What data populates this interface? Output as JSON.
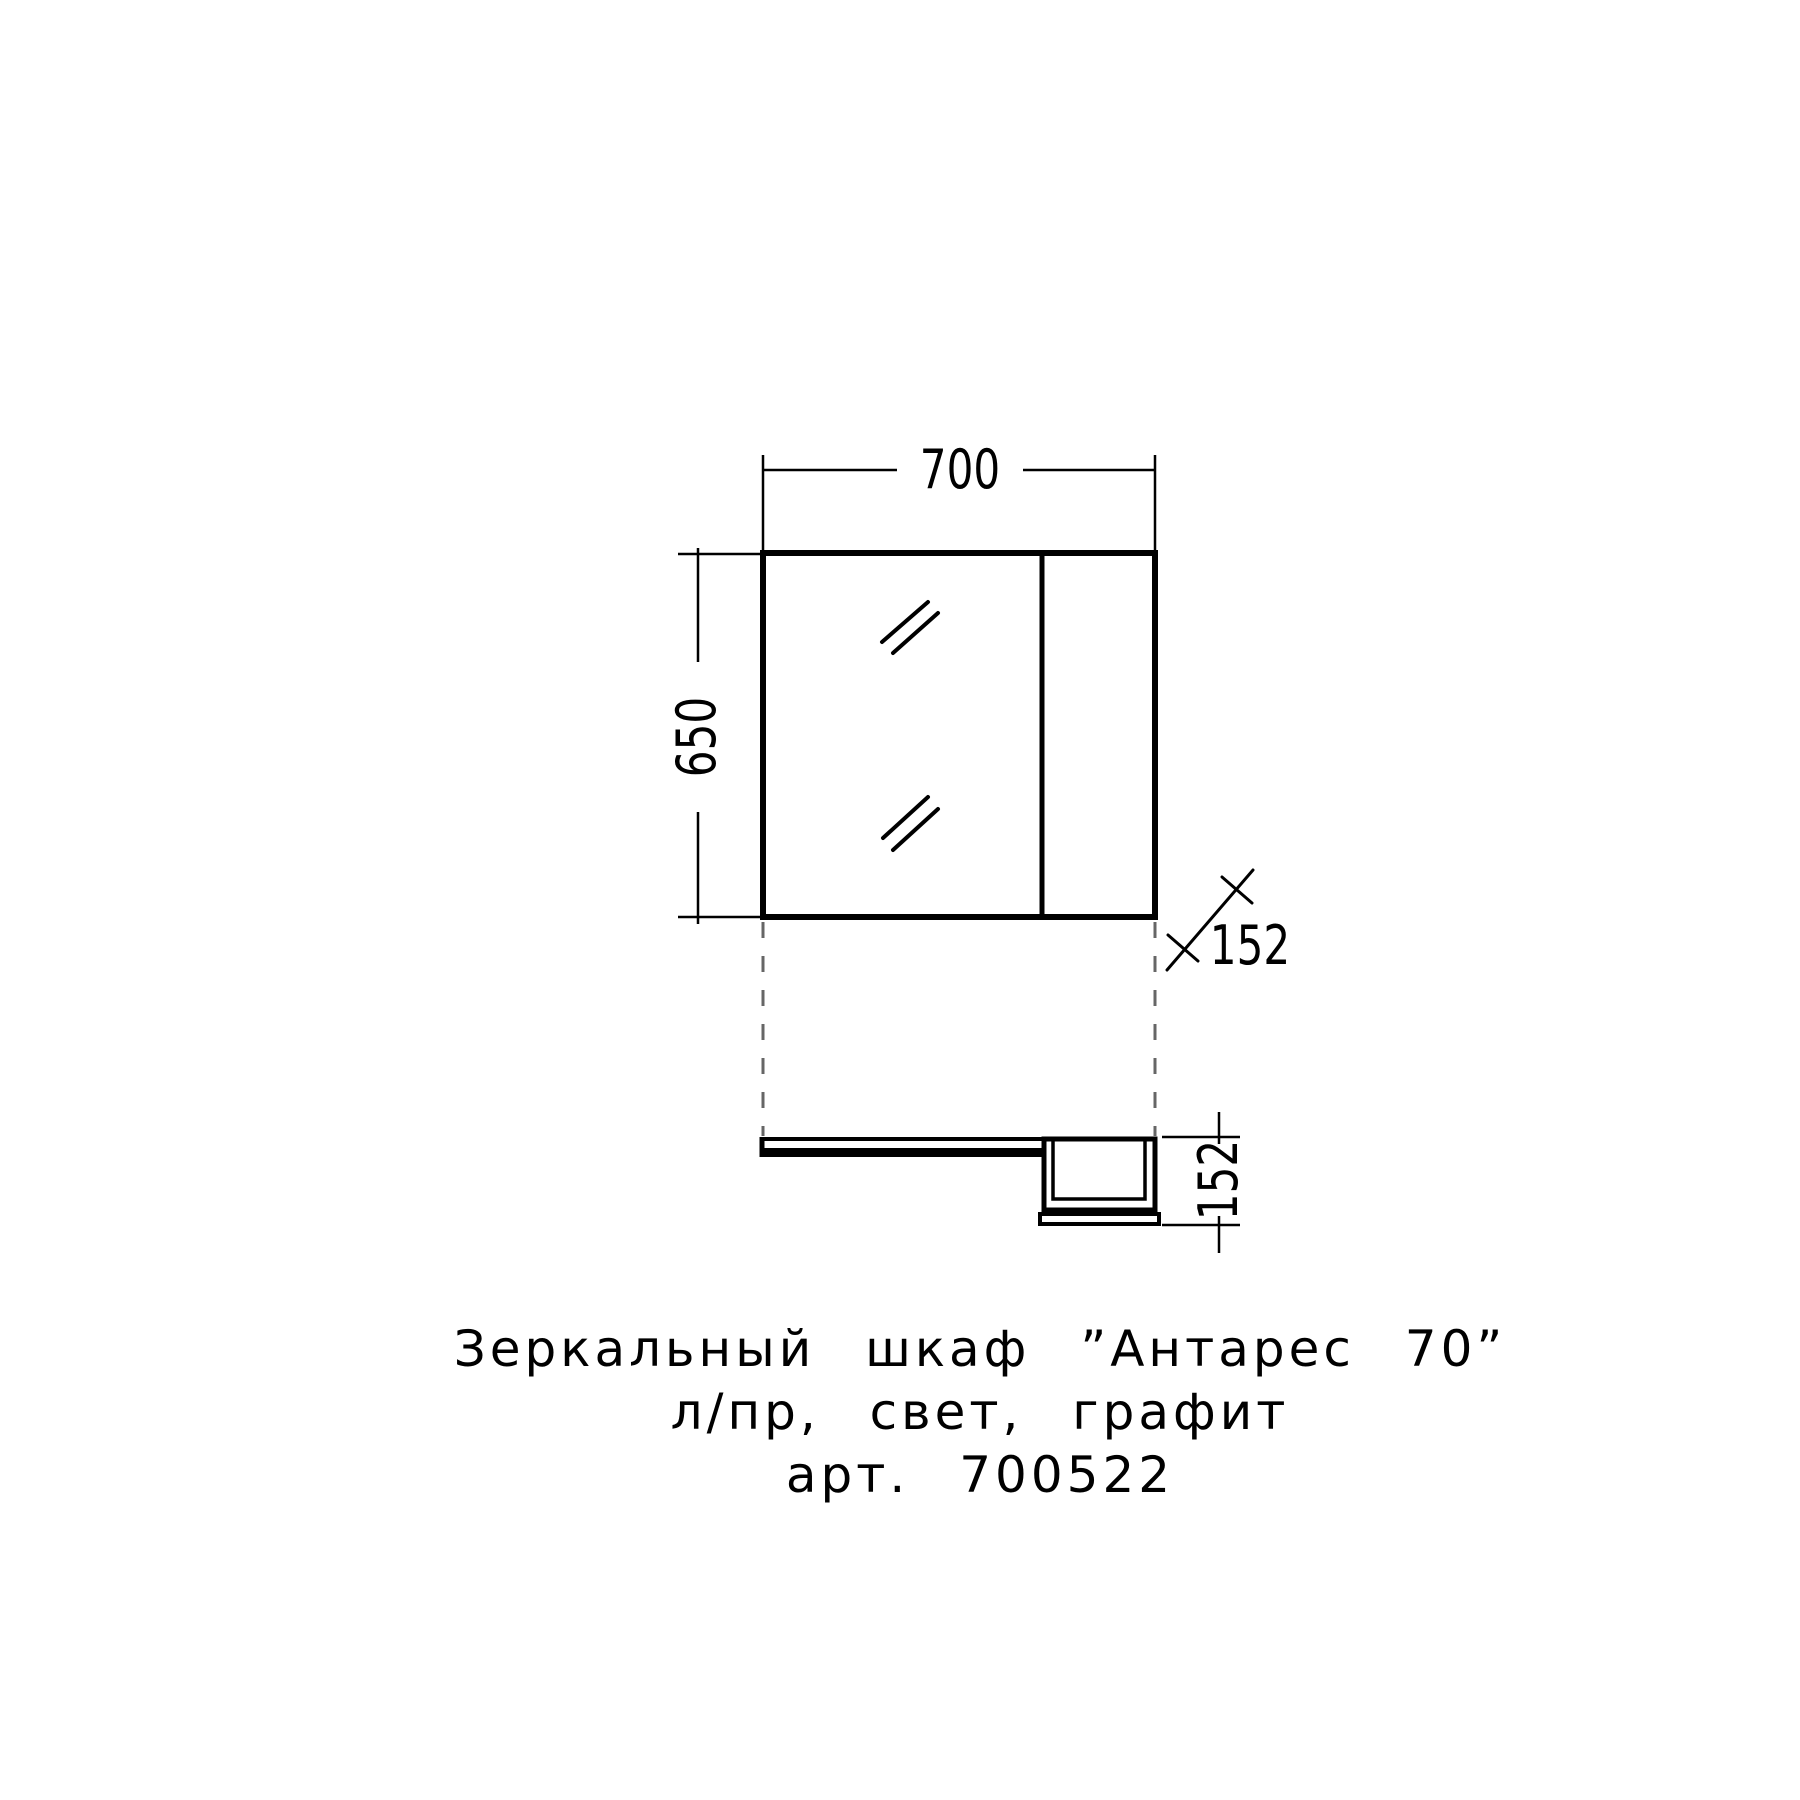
{
  "dims": {
    "width": "700",
    "height": "650",
    "depth_oblique": "152",
    "depth_side": "152"
  },
  "caption": {
    "line1": "Зеркальный шкаф ”Антарес 70”",
    "line2": "л/пр, свет, графит",
    "line3": "арт. 700522"
  },
  "colors": {
    "line": "#000000",
    "projection_line": "#666666",
    "background": "#ffffff"
  }
}
